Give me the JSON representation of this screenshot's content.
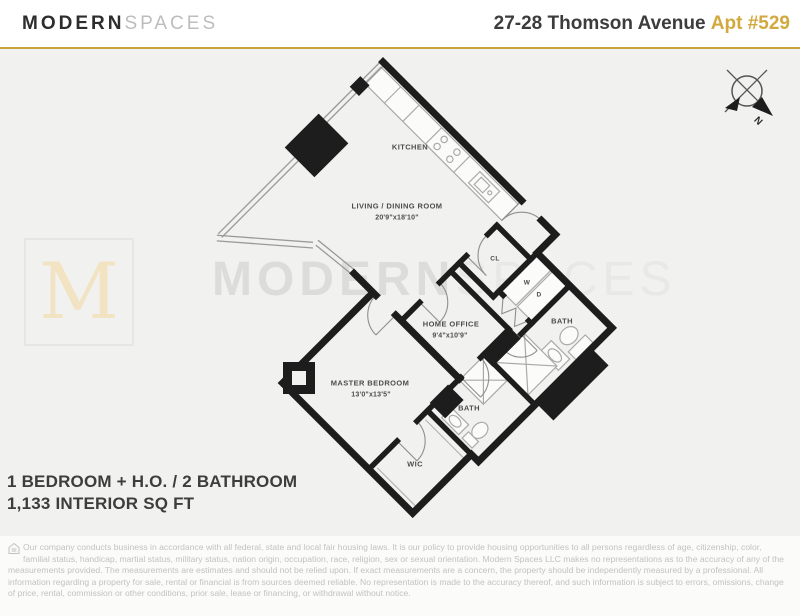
{
  "header": {
    "brand_bold": "MODERN",
    "brand_light": "SPACES",
    "address": "27-28 Thomson Avenue",
    "unit": "Apt #529"
  },
  "compass": {
    "north_label": "N"
  },
  "watermark": {
    "bold": "MODERN",
    "light": "SPACES",
    "monogram": "M"
  },
  "rooms": [
    {
      "name": "KITCHEN"
    },
    {
      "name": "LIVING / DINING ROOM",
      "dims": "20'9\"x18'10\""
    },
    {
      "name": "CL"
    },
    {
      "name": "W"
    },
    {
      "name": "D"
    },
    {
      "name": "BATH"
    },
    {
      "name": "HOME OFFICE",
      "dims": "9'4\"x10'9\""
    },
    {
      "name": "MASTER BEDROOM",
      "dims": "13'0\"x13'5\""
    },
    {
      "name": "BATH"
    },
    {
      "name": "WIC"
    }
  ],
  "summary": {
    "line1": "1 BEDROOM + H.O. / 2 BATHROOM",
    "line2": "1,133 INTERIOR SQ FT"
  },
  "disclaimer": {
    "icon": "equal-housing-icon",
    "text": "Our company conducts business in accordance with all federal, state and local fair housing laws. It is our policy to provide housing opportunities to all persons regardless of age, citizenship, color, familial status, handicap, martial status, military status, nation origin, occupation, race, religion, sex or sexual orientation. Modern Spaces LLC makes no representations as to the accuracy of any of the measurements provided. The measurements are estimates and should not be relied upon. If exact measurements are a concern, the property should be independently measured by a professional. All information regarding a property for sale, rental or financial is from  sources deemed reliable. No representation is made to the accuracy thereof, and such information is subject to errors, omissions, change of price, rental, commission or other conditions, prior sale, lease or financing, or withdrawal without notice."
  },
  "colors": {
    "gold": "#C8A33B",
    "unit_gold": "#D2A93E",
    "wall": "#1D1D1D",
    "plan_background": "#F1F1EF",
    "label": "#4C4C4C",
    "watermark_gray": "#DCDCDA",
    "monogram_gold": "#F2E3C2"
  }
}
